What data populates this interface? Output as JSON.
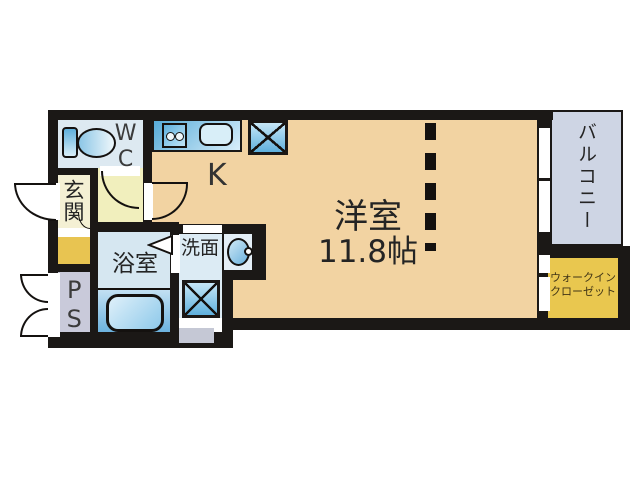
{
  "plan": {
    "type": "apartment-floorplan",
    "rooms": {
      "wc": {
        "label": "WC"
      },
      "genkan": {
        "label": "玄関"
      },
      "ps": {
        "label": "PS"
      },
      "bath": {
        "label": "浴室"
      },
      "wash": {
        "label": "洗面"
      },
      "kitchen": {
        "label": "K"
      },
      "main": {
        "label": "洋室",
        "size": "11.8帖"
      },
      "balcony": {
        "label": "バルコニー"
      },
      "wic": {
        "label_line1": "ウォークイン",
        "label_line2": "クローゼット"
      }
    },
    "fixtures": [
      "toilet",
      "kitchen-stove",
      "kitchen-sink",
      "refrigerator-space",
      "bathtub",
      "washbasin",
      "washing-machine-space",
      "folding-bath-door",
      "entrance-door",
      "ps-double-door",
      "partition-dashed-line"
    ],
    "colors": {
      "wall": "#1b1816",
      "floor-main": "#f2d3a2",
      "floor-wc": "#dde9f1",
      "floor-genkan": "#f4f0d4",
      "floor-hall": "#f1efbd",
      "gold": "#e8c451",
      "floor-ps": "#c9cada",
      "floor-bath": "#d6e7f1",
      "floor-wash": "#dcebf4",
      "floor-balcony": "#ced5e4",
      "floor-wic": "#e9c74f",
      "gray-step": "#c5c8d5",
      "fixture-blue-dark": "#57abd8",
      "fixture-blue-light": "#d8eefa"
    }
  }
}
